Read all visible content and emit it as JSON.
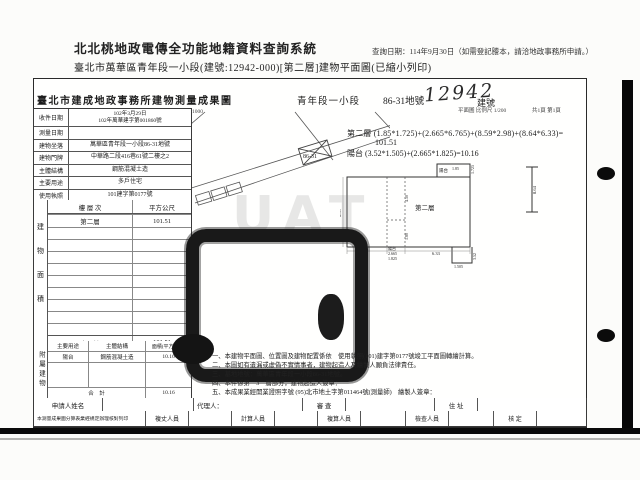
{
  "app": {
    "title": "北北桃地政電傳全功能地籍資料查詢系統",
    "query_date": "查詢日期：114年9月30日（如需登記謄本，請洽地政事務所申請。）",
    "subtitle": "臺北市萬華區青年段一小段(建號:12942-000)[第二層]建物平面圖(已縮小列印)"
  },
  "doc": {
    "title": "臺北市建成地政事務所建物測量成果圖",
    "section": "青年段一小段",
    "parcel": "86-31地號",
    "building_no": "12942",
    "building_no_label": "建號",
    "plan_scale": "平面圖 比例尺 1/200",
    "page_info": "共1頁 第1頁",
    "map_scale": "位置圖 比例尺 1/1000",
    "map_parcel_label": "86-31"
  },
  "info_table": {
    "rows": [
      {
        "label": "收件日期",
        "value": "102年3月29日",
        "value2": "102年萬華建字第001860號"
      },
      {
        "label": "測量日期",
        "value": ""
      },
      {
        "label": "建物坐落",
        "value": "萬華區青年段一小段86-31地號"
      },
      {
        "label": "建物門牌",
        "value": "中華路二段416巷61號二樓之2"
      },
      {
        "label": "主體結構",
        "value": "鋼筋混凝土造"
      },
      {
        "label": "主要用途",
        "value": "多戶住宅"
      },
      {
        "label": "使用執照",
        "value": "101建字第0177號"
      }
    ]
  },
  "area_table": {
    "side_label": "建物面積",
    "col_floor": "樓 層 次",
    "col_area": "平方公尺",
    "floor": "第二層",
    "floor_area": "101.51",
    "total_label": "合　計",
    "total": "101.51"
  },
  "annex_table": {
    "side_label": "附屬建物",
    "col_use": "主要用途",
    "col_structure": "主體結構",
    "col_area": "面積(平方公尺)",
    "use": "陽台",
    "structure": "鋼筋混凝土造",
    "area": "10.16",
    "total_label": "合　計",
    "total": "10.16"
  },
  "formulas": {
    "line1": "第二層 (1.85*1.725)+(2.665*6.765)+(8.59*2.98)+(8.64*6.33)=",
    "line1b": "101.51",
    "line2": "陽台 (3.52*1.505)+(2.665*1.825)=10.16"
  },
  "notes": {
    "n1": "一、本建物平面圖、位置圖及建物配置係依　使用執照(101)建字第0177號竣工平面圖轉繪計算。",
    "n2": "二、本圖如有遺漏或虛偽不實情事者，建物起造人及繪製人願負法律責任。",
    "n3": "三、基地地號：萬華區青年段一小段86-31地號。",
    "n4": "四、本件係第　3　層部分，建物起造人簽章：",
    "n5": "五、本成果業經開業證照字號 (95)北市地土字第011464號(測量師)　繪製人簽章："
  },
  "plan": {
    "floor_label": "第二層",
    "balcony_label": "陽台",
    "dims": {
      "a": "1.85",
      "b": "1.725",
      "c": "8.59",
      "d": "2.98",
      "e": "2.665",
      "f": "1.825",
      "g": "6.33",
      "h": "8.64",
      "i": "4.50",
      "j": "1.80",
      "k": "3.52",
      "l": "1.505"
    }
  },
  "footer": {
    "applicant_label": "申請人姓名",
    "agent_label": "代理人：",
    "review_label": "審 查",
    "address_label": "住 址",
    "note": "本測量成果圖分算表業經規定辦理核對列印",
    "staff": [
      "複丈人員",
      "計算人員",
      "複算人員",
      "檢查人員",
      "核 定"
    ]
  },
  "watermark": "UAT"
}
